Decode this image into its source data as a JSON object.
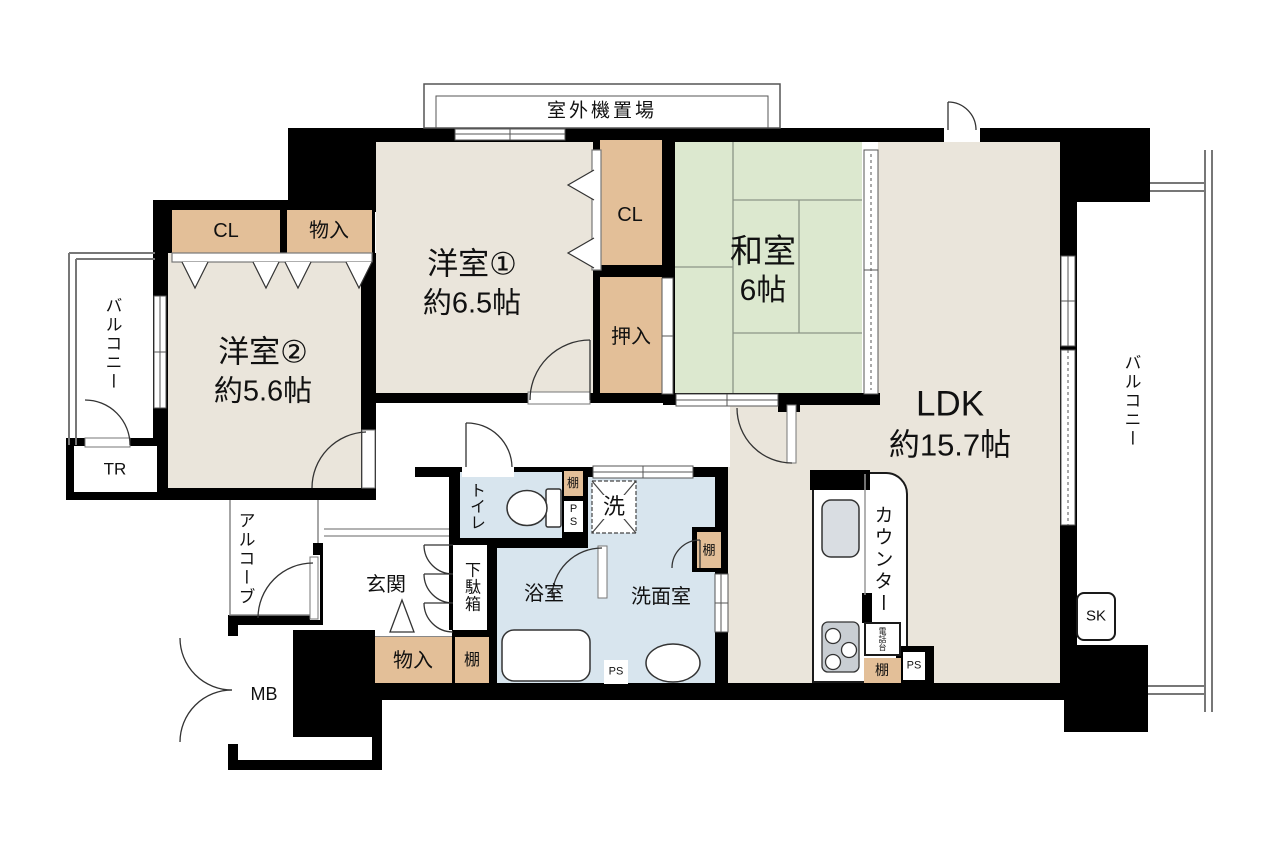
{
  "title": "マンション間取り図 (3LDK floor plan)",
  "colors": {
    "wall": "#000000",
    "floor_beige": "#EAE5DB",
    "closet_tan": "#E3BF98",
    "tatami_green": "#DCE8CF",
    "wet_area_blue": "#D8E5EE",
    "fixture_gray": "#D2D7DC"
  },
  "labels": {
    "outdoor_unit": "室外機置場",
    "room1_name": "洋室①",
    "room1_size": "約6.5帖",
    "room2_name": "洋室②",
    "room2_size": "約5.6帖",
    "washitsu_name": "和室",
    "washitsu_size": "6帖",
    "ldk_name": "LDK",
    "ldk_size": "約15.7帖",
    "cl": "CL",
    "monoiri": "物入",
    "oshiire": "押入",
    "balcony": "バルコニー",
    "tr": "TR",
    "alcove": "アルコーブ",
    "mb": "MB",
    "genkan": "玄関",
    "getabako": "下駄箱",
    "tana": "棚",
    "ps": "PS",
    "toilet": "トイレ",
    "washer": "洗",
    "bathroom": "浴室",
    "washroom": "洗面室",
    "counter": "カウンター",
    "denwadai": "電話台",
    "sk": "SK"
  }
}
